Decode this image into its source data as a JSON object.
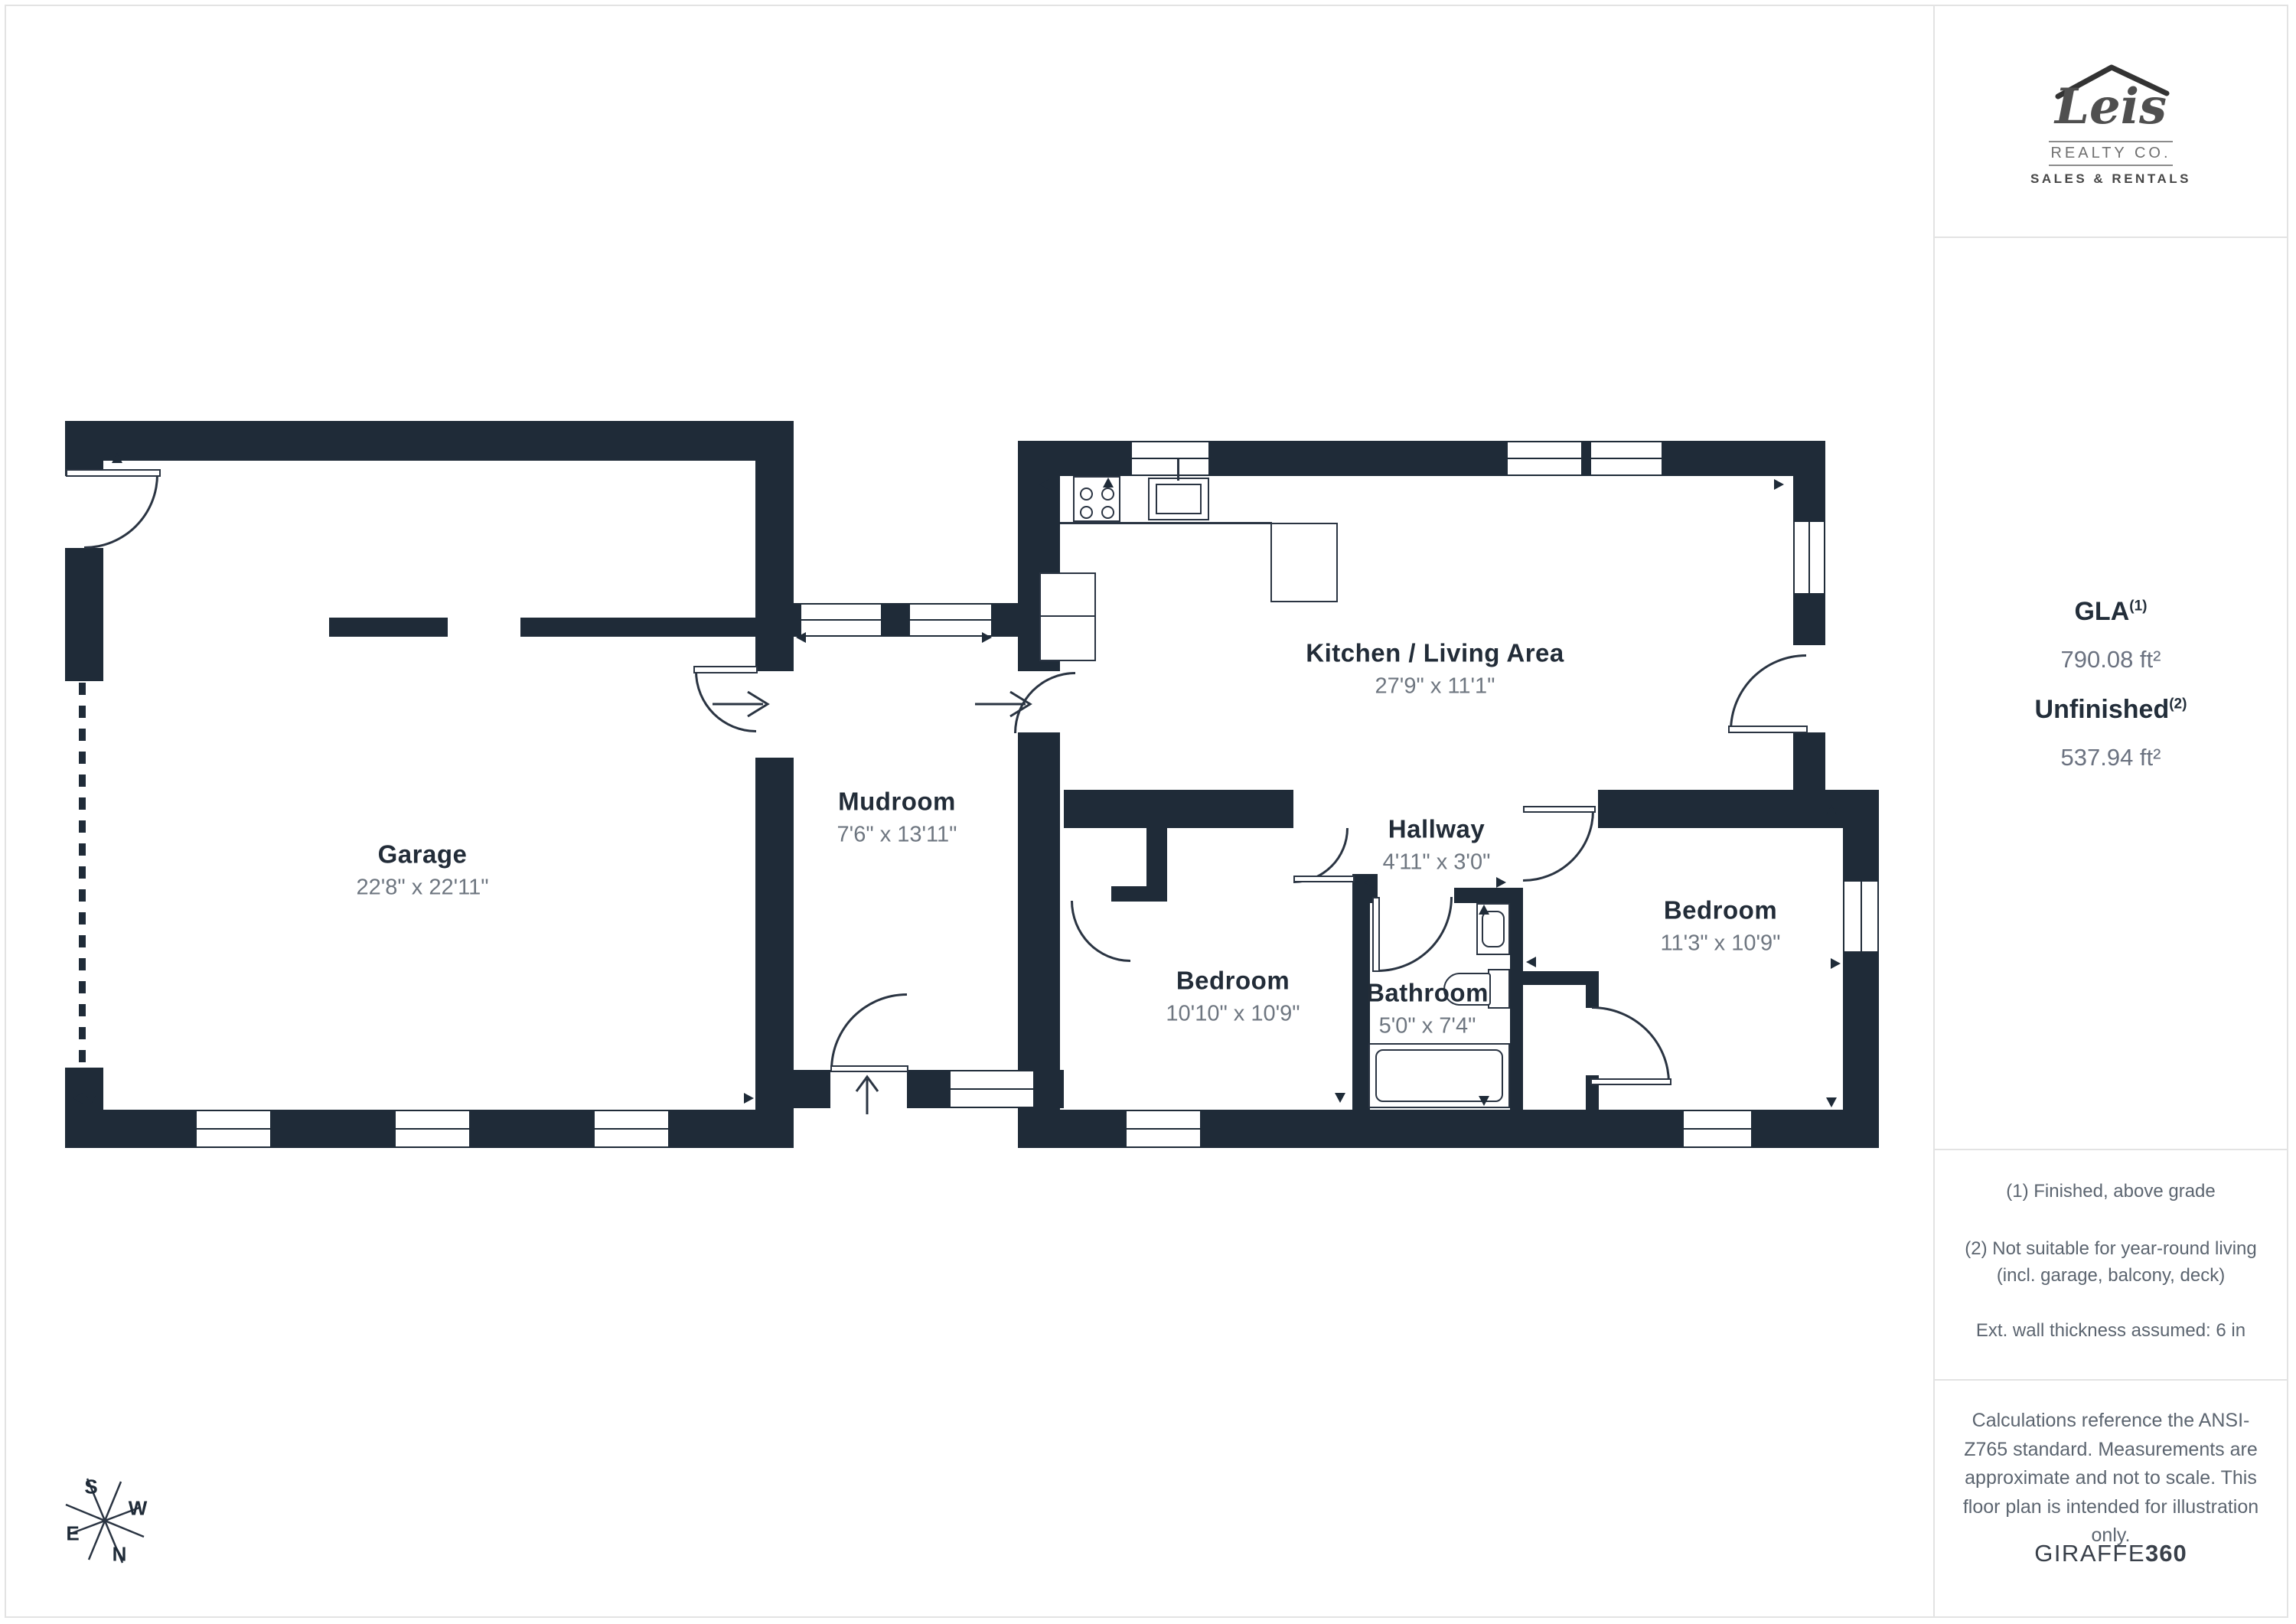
{
  "sidebar": {
    "logo": {
      "name": "Leis",
      "realty": "REALTY CO.",
      "tagline": "SALES & RENTALS"
    },
    "stats": {
      "gla_label": "GLA",
      "gla_sup": "(1)",
      "gla_value": "790.08 ft²",
      "unfinished_label": "Unfinished",
      "unfinished_sup": "(2)",
      "unfinished_value": "537.94 ft²"
    },
    "notes": {
      "note1": "(1) Finished, above grade",
      "note2": "(2) Not suitable for year-round living (incl. garage, balcony, deck)",
      "note3": "Ext. wall thickness assumed: 6 in"
    },
    "disclaimer": "Calculations reference the ANSI-Z765 standard. Measurements are approximate and not to scale. This floor plan is intended for illustration only.",
    "provider": {
      "name": "GIRAFFE",
      "suffix": "360"
    }
  },
  "compass": {
    "n": "N",
    "s": "S",
    "e": "E",
    "w": "W"
  },
  "rooms": [
    {
      "name": "Garage",
      "dims": "22'8\" x 22'11\""
    },
    {
      "name": "Mudroom",
      "dims": "7'6\" x 13'11\""
    },
    {
      "name": "Kitchen / Living Area",
      "dims": "27'9\" x 11'1\""
    },
    {
      "name": "Hallway",
      "dims": "4'11\" x 3'0\""
    },
    {
      "name": "Bedroom",
      "dims": "10'10\" x 10'9\""
    },
    {
      "name": "Bathroom",
      "dims": "5'0\" x 7'4\""
    },
    {
      "name": "Bedroom",
      "dims": "11'3\" x 10'9\""
    }
  ]
}
